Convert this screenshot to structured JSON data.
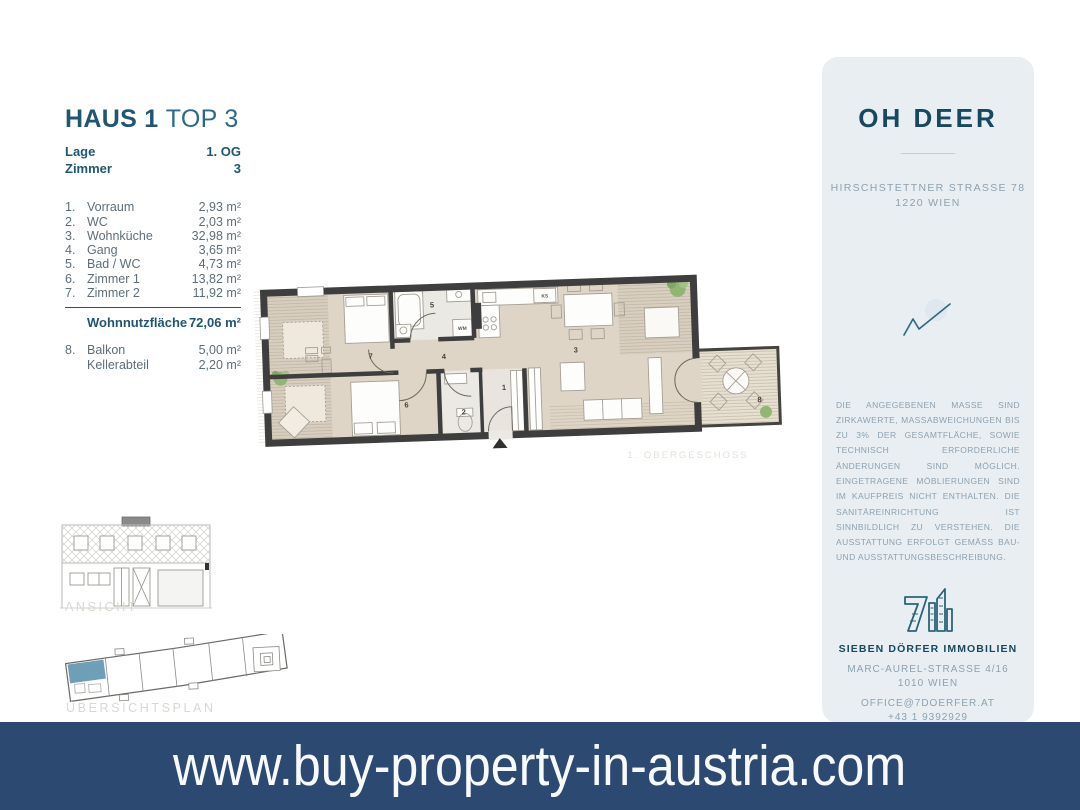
{
  "info": {
    "title_main": "HAUS 1",
    "title_sub": "TOP 3",
    "meta": [
      {
        "label": "Lage",
        "value": "1. OG"
      },
      {
        "label": "Zimmer",
        "value": "3"
      }
    ],
    "rooms": [
      {
        "num": "1.",
        "name": "Vorraum",
        "area": "2,93 m²"
      },
      {
        "num": "2.",
        "name": "WC",
        "area": "2,03 m²"
      },
      {
        "num": "3.",
        "name": "Wohnküche",
        "area": "32,98 m²"
      },
      {
        "num": "4.",
        "name": "Gang",
        "area": "3,65 m²"
      },
      {
        "num": "5.",
        "name": "Bad / WC",
        "area": "4,73 m²"
      },
      {
        "num": "6.",
        "name": "Zimmer 1",
        "area": "13,82 m²"
      },
      {
        "num": "7.",
        "name": "Zimmer 2",
        "area": "11,92 m²"
      }
    ],
    "total_label": "Wohnnutzfläche",
    "total_value": "72,06 m²",
    "extras": [
      {
        "num": "8.",
        "name": "Balkon",
        "area": "5,00 m²"
      },
      {
        "num": "",
        "name": "Kellerabteil",
        "area": "2,20 m²"
      }
    ]
  },
  "floorplan": {
    "caption": "1. OBERGESCHOSS",
    "room_numbers": [
      "1",
      "2",
      "3",
      "4",
      "5",
      "6",
      "7",
      "8"
    ],
    "labels": {
      "fridge": "KS",
      "washer": "WM"
    }
  },
  "drawings": {
    "elevation_caption": "ANSICHT",
    "siteplan_caption": "ÜBERSICHTSPLAN"
  },
  "sidebar": {
    "project_name": "OH DEER",
    "address_line1": "HIRSCHSTETTNER STRASSE 78",
    "address_line2": "1220 WIEN",
    "disclaimer": "DIE ANGEGEBENEN MASSE SIND ZIRKAWERTE, MASSABWEICHUNGEN BIS ZU 3% DER GESAMTFLÄCHE, SOWIE TECHNISCH ERFORDERLICHE ÄNDERUNGEN SIND MÖGLICH. EINGETRAGENE MÖBLIERUNGEN SIND IM KAUFPREIS NICHT ENTHALTEN. DIE SANITÄREINRICHTUNG IST SINNBILDLICH ZU VERSTEHEN. DIE AUSSTATTUNG ERFOLGT GEMÄSS BAU- UND AUSSTATTUNGSBESCHREIBUNG.",
    "company": "SIEBEN DÖRFER IMMOBILIEN",
    "company_address1": "MARC-AUREL-STRASSE 4/16",
    "company_address2": "1010 WIEN",
    "email": "OFFICE@7DOERFER.AT",
    "phone": "+43 1 9392929"
  },
  "footer": {
    "url": "www.buy-property-in-austria.com"
  },
  "colors": {
    "brand_dark": "#1f5674",
    "table_gray": "#5e6e77",
    "muted_blue": "#8ca2b0",
    "sidebar_bg": "#e9eef3",
    "banner_bg": "#2c4a71",
    "caption_gray": "#d9d8d3",
    "plan_wall": "#3e3e3e",
    "plan_floor": "#ded5c6",
    "siteplan_highlight": "#6f9eb7"
  }
}
